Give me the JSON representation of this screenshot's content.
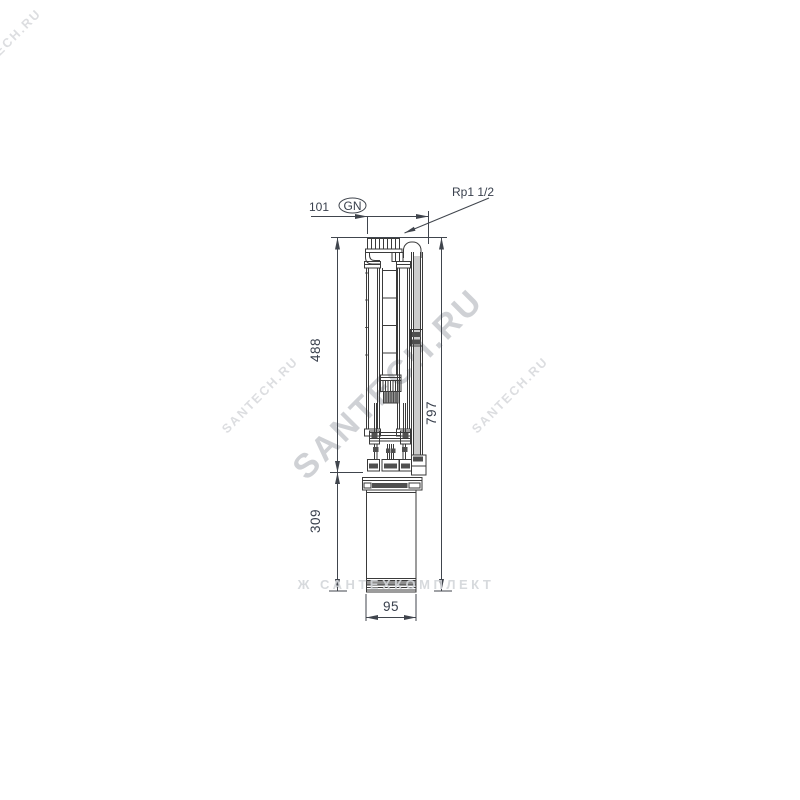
{
  "dimensions": {
    "top_width": "101",
    "marker": "GN",
    "connection": "Rp1 1/2",
    "pump_length": "488",
    "motor_length": "309",
    "overall_length": "797",
    "diameter": "95"
  },
  "watermarks": {
    "main": "SANTECH.RU",
    "side_left": "SANTECH.RU",
    "side_right": "SANTECH.RU",
    "corner": "SANTECH.RU",
    "bottom": "Ж САНТЕХКОМПЛЕКТ"
  },
  "colors": {
    "background": "#ffffff",
    "drawing_line": "#3a3a3a",
    "dimension_line": "#40454d",
    "label_text": "#39404d",
    "dark_detail": "#4f4f4f",
    "watermark_main": "#a9adb3",
    "watermark_faint": "#c5c8cd"
  }
}
